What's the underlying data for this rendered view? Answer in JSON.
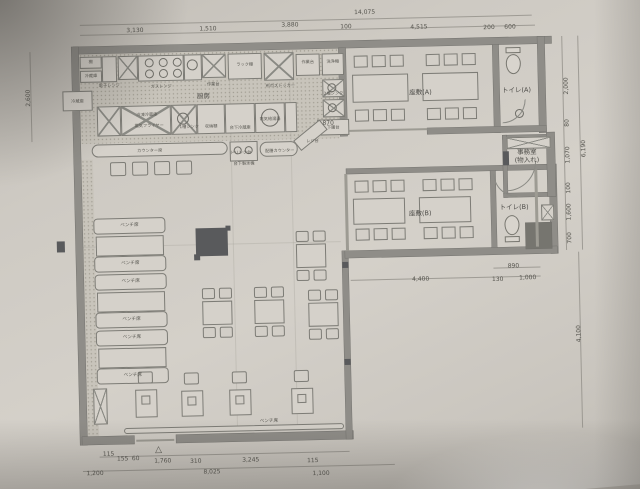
{
  "document": {
    "kind": "hand-photographed architectural floor plan (restaurant)",
    "colors": {
      "paper": "#cfccc5",
      "line": "#6e6d69",
      "wall": "#8f8d88",
      "dark_fill": "#595a5c"
    }
  },
  "annotations": {
    "dimensions": [
      {
        "text": "14,075",
        "x": 370,
        "y": 14
      },
      {
        "text": "3,130",
        "x": 140,
        "y": 27
      },
      {
        "text": "1,510",
        "x": 213,
        "y": 27
      },
      {
        "text": "3,880",
        "x": 295,
        "y": 25
      },
      {
        "text": "100",
        "x": 351,
        "y": 28
      },
      {
        "text": "4,515",
        "x": 424,
        "y": 30
      },
      {
        "text": "200",
        "x": 494,
        "y": 32
      },
      {
        "text": "600",
        "x": 515,
        "y": 32
      },
      {
        "text": "2,600",
        "x": 32,
        "y": 92,
        "rot": -90
      },
      {
        "text": "2,000",
        "x": 570,
        "y": 92,
        "rot": -90
      },
      {
        "text": "80",
        "x": 570,
        "y": 129,
        "rot": -90
      },
      {
        "text": "1,070",
        "x": 570,
        "y": 161,
        "rot": -90
      },
      {
        "text": "100",
        "x": 570,
        "y": 194,
        "rot": -90
      },
      {
        "text": "1,600",
        "x": 570,
        "y": 218,
        "rot": -90
      },
      {
        "text": "700",
        "x": 570,
        "y": 244,
        "rot": -90
      },
      {
        "text": "6,190",
        "x": 586,
        "y": 155,
        "rot": -90
      },
      {
        "text": "4,100",
        "x": 577,
        "y": 340,
        "rot": -90
      },
      {
        "text": "890",
        "x": 513,
        "y": 271
      },
      {
        "text": "4,400",
        "x": 420,
        "y": 282
      },
      {
        "text": "130",
        "x": 497,
        "y": 284
      },
      {
        "text": "1,000",
        "x": 527,
        "y": 283
      },
      {
        "text": "870",
        "x": 331,
        "y": 124
      },
      {
        "text": "115",
        "x": 104,
        "y": 450
      },
      {
        "text": "155",
        "x": 118,
        "y": 455
      },
      {
        "text": "60",
        "x": 131,
        "y": 455
      },
      {
        "text": "1,760",
        "x": 158,
        "y": 458
      },
      {
        "text": "310",
        "x": 191,
        "y": 459
      },
      {
        "text": "3,245",
        "x": 246,
        "y": 459
      },
      {
        "text": "115",
        "x": 308,
        "y": 461
      },
      {
        "text": "1,200",
        "x": 90,
        "y": 469
      },
      {
        "text": "8,025",
        "x": 207,
        "y": 470
      },
      {
        "text": "1,100",
        "x": 316,
        "y": 474
      }
    ],
    "room_labels": [
      {
        "text": "座敷(A)",
        "x": 424,
        "y": 96
      },
      {
        "text": "トイレ(A)",
        "x": 520,
        "y": 96
      },
      {
        "text": "事務室\n(物入れ)",
        "x": 529,
        "y": 162
      },
      {
        "text": "座敷(B)",
        "x": 421,
        "y": 217
      },
      {
        "text": "トイレ(B)",
        "x": 515,
        "y": 213
      },
      {
        "text": "厨房",
        "x": 207,
        "y": 95
      }
    ],
    "equipment_labels": [
      {
        "text": "棚",
        "x": 95,
        "y": 57
      },
      {
        "text": "冷蔵庫",
        "x": 95,
        "y": 71
      },
      {
        "text": "電子レンジ",
        "x": 113,
        "y": 81
      },
      {
        "text": "ガスレンジ",
        "x": 165,
        "y": 83
      },
      {
        "text": "作業台",
        "x": 217,
        "y": 82
      },
      {
        "text": "ラック棚",
        "x": 249,
        "y": 63
      },
      {
        "text": "布巾ストッカー",
        "x": 284,
        "y": 85
      },
      {
        "text": "作業台",
        "x": 312,
        "y": 62
      },
      {
        "text": "洗浄機",
        "x": 337,
        "y": 62
      },
      {
        "text": "2槽シンク",
        "x": 337,
        "y": 94
      },
      {
        "text": "下膳台",
        "x": 336,
        "y": 128
      },
      {
        "text": "冷蔵庫",
        "x": 81,
        "y": 96
      },
      {
        "text": "冷凍冷蔵庫",
        "x": 150,
        "y": 111
      },
      {
        "text": "電気フライヤー",
        "x": 152,
        "y": 122
      },
      {
        "text": "1槽シンク",
        "x": 192,
        "y": 124
      },
      {
        "text": "収納棚",
        "x": 214,
        "y": 124
      },
      {
        "text": "台下冷蔵庫",
        "x": 243,
        "y": 126
      },
      {
        "text": "電気給湯器",
        "x": 273,
        "y": 118
      },
      {
        "text": "カウンター席",
        "x": 152,
        "y": 147
      },
      {
        "text": "ドリンク台",
        "x": 243,
        "y": 151
      },
      {
        "text": "台下製氷機",
        "x": 246,
        "y": 162
      },
      {
        "text": "配膳カウンター",
        "x": 282,
        "y": 150
      },
      {
        "text": "レジ台",
        "x": 315,
        "y": 141
      }
    ],
    "bench_labels": [
      {
        "text": "ベンチ席",
        "x": 130,
        "y": 222
      },
      {
        "text": "ベンチ席",
        "x": 130,
        "y": 260
      },
      {
        "text": "ベンチ席",
        "x": 130,
        "y": 278
      },
      {
        "text": "ベンチ席",
        "x": 130,
        "y": 316
      },
      {
        "text": "ベンチ席",
        "x": 130,
        "y": 334
      },
      {
        "text": "ベンチ席",
        "x": 130,
        "y": 372
      },
      {
        "text": "ベンチ席",
        "x": 265,
        "y": 421
      }
    ],
    "marks": [
      {
        "text": "△",
        "x": 154,
        "y": 447
      }
    ]
  }
}
